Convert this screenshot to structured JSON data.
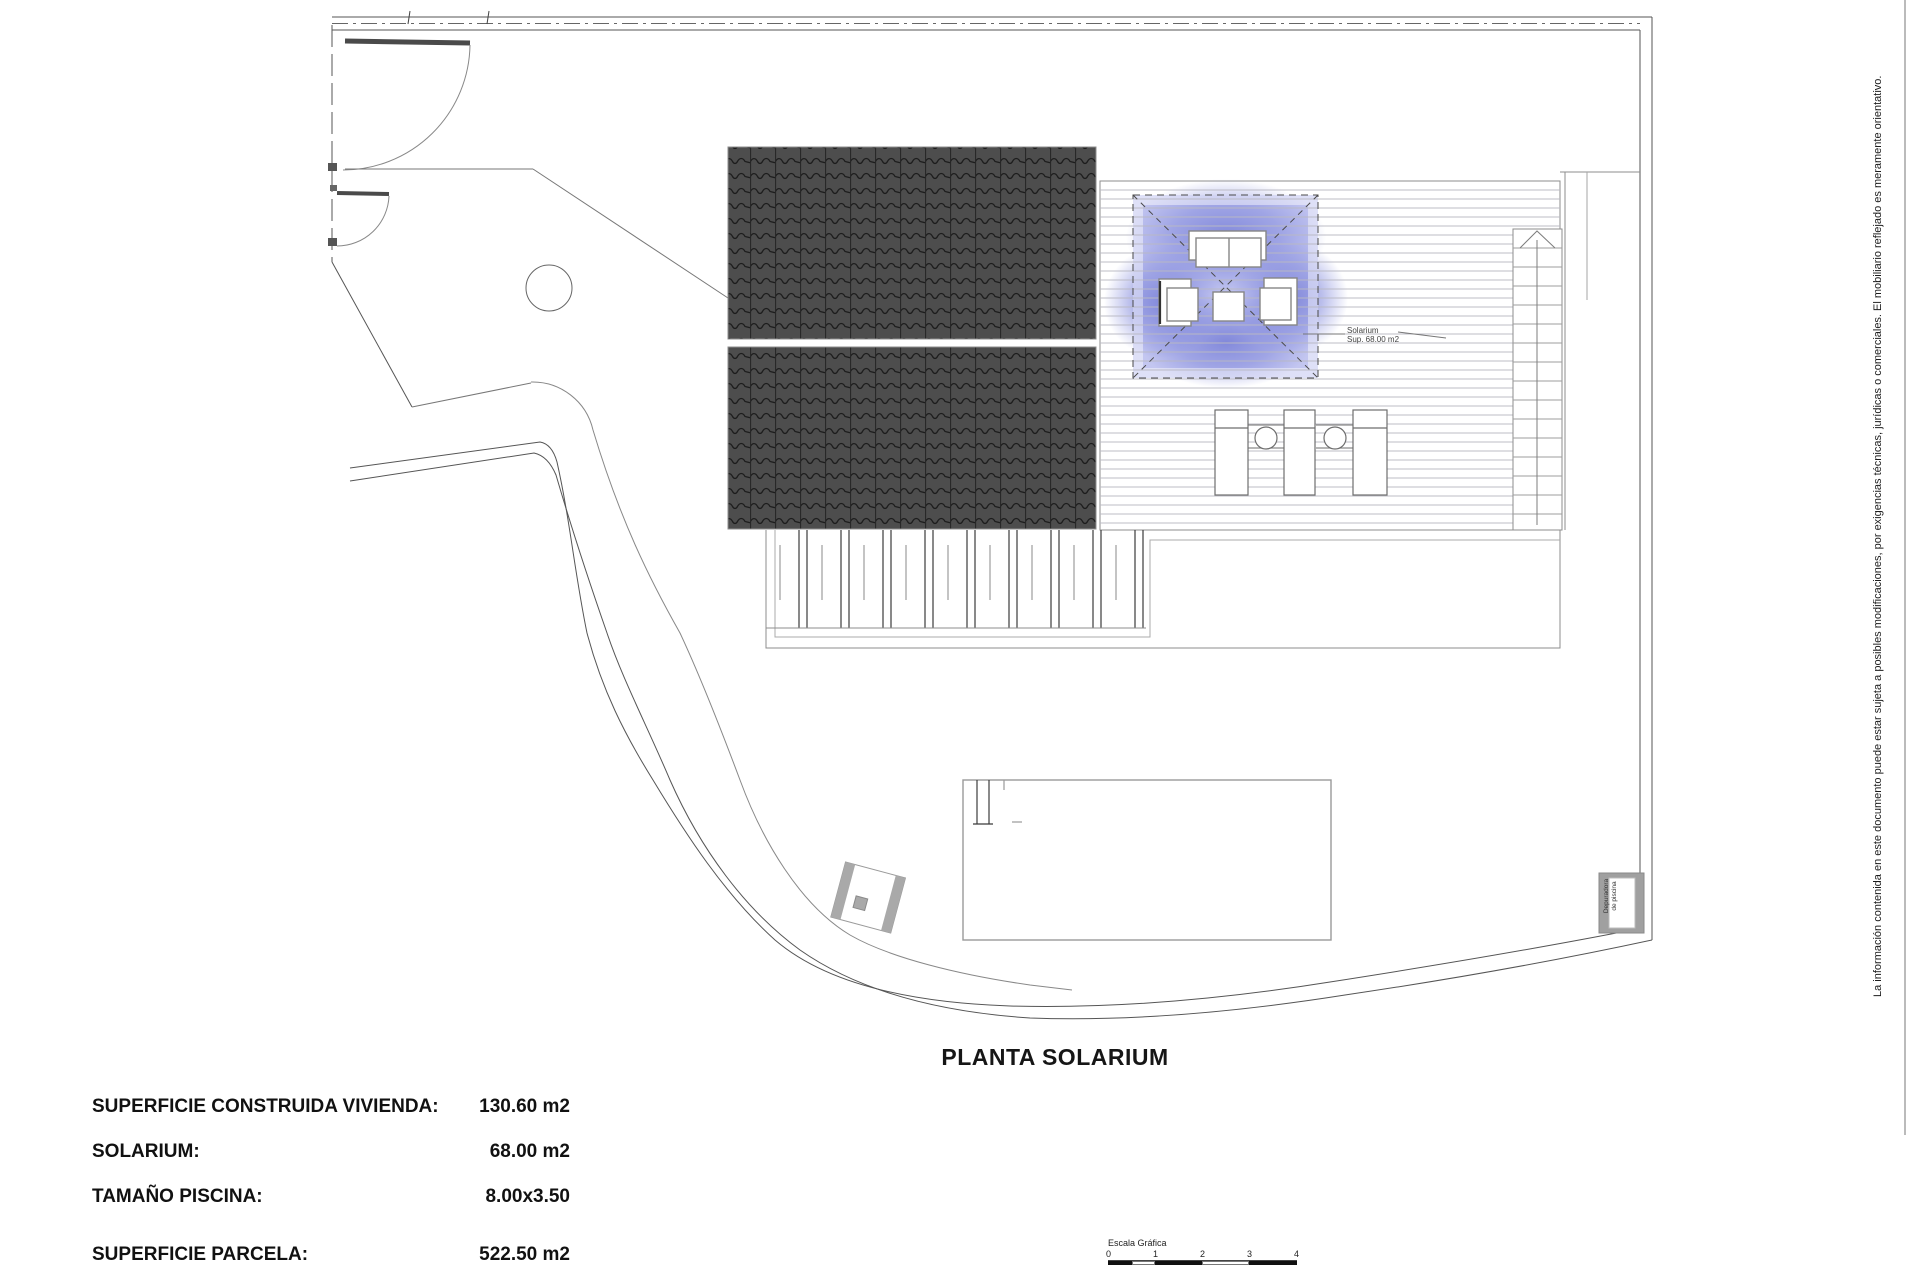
{
  "title": "PLANTA SOLARIUM",
  "summary": {
    "rows": [
      {
        "label": "SUPERFICIE CONSTRUIDA VIVIENDA:",
        "value": "130.60 m2"
      },
      {
        "label": "SOLARIUM:",
        "value": "68.00 m2"
      },
      {
        "label": "TAMAÑO PISCINA:",
        "value": "8.00x3.50"
      },
      {
        "label": "SUPERFICIE PARCELA:",
        "value": "522.50 m2"
      }
    ]
  },
  "scale_bar": {
    "label": "Escala Gráfica",
    "ticks": [
      "0",
      "1",
      "2",
      "3",
      "4"
    ]
  },
  "solarium_note": {
    "line1": "Solarium",
    "line2": "Sup. 68.00 m2"
  },
  "equipment_box": {
    "line1": "Depuradora",
    "line2": "de piscina"
  },
  "disclaimer": "La información contenida en este documento puede estar sujeta a posibles modificaciones, por exigencias técnicas, jurídicas o comerciales. El mobiliario reflejado es meramente orientativo.",
  "colors": {
    "solarium_base": "#c3c6f0",
    "solarium_glow": "#7b82d8",
    "roof_tiles": "#4d4d4d",
    "linework": "#555555",
    "deck_lines": "#c6c6c6"
  }
}
